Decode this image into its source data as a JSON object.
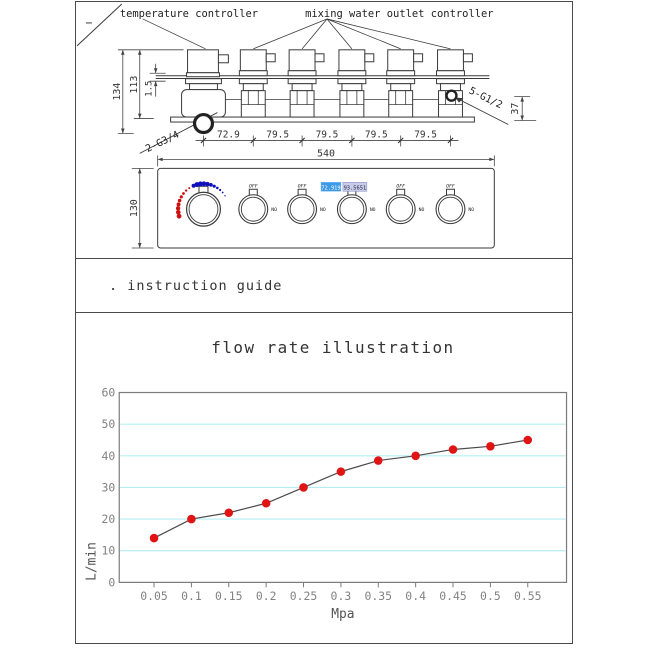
{
  "drawing": {
    "labels": {
      "temperature_controller": "temperature controller",
      "mixing_controller": "mixing water outlet controller",
      "port_bottom": "2-G3/4",
      "port_side": "5-G1/2"
    },
    "dims": {
      "total_height": "134",
      "body_height": "113",
      "pipe_offset": "1.5",
      "side_depth": "37",
      "spacing_labels": [
        "72.9",
        "79.5",
        "79.5",
        "79.5",
        "79.5"
      ],
      "total_width": "540",
      "panel_height": "130"
    },
    "panel": {
      "knob_top_label": "OFF",
      "knob_side_label": "NO",
      "display_value_1": "172.9199",
      "display_value_2": "93.5651",
      "knob_count": 6,
      "temp_arc_hot_color": "#cc1111",
      "temp_arc_cold_color": "#1111bb"
    }
  },
  "instruction": {
    "text": ". instruction guide"
  },
  "chart_data": {
    "type": "line",
    "title": "flow rate illustration",
    "xlabel": "Mpa",
    "ylabel": "L/min",
    "x": [
      0.05,
      0.1,
      0.15,
      0.2,
      0.25,
      0.3,
      0.35,
      0.4,
      0.45,
      0.5,
      0.55
    ],
    "x_tick_labels": [
      "0.05",
      "0.1",
      "0.15",
      "0.2",
      "0.25",
      "0.3",
      "0.35",
      "0.4",
      "0.45",
      "0.5",
      "0.55"
    ],
    "values": [
      14,
      20,
      22,
      25,
      30,
      35,
      38.5,
      40,
      42,
      43,
      45
    ],
    "y_ticks": [
      0,
      10,
      20,
      30,
      40,
      50,
      60
    ],
    "ylim": [
      0,
      60
    ],
    "grid": true,
    "legend_position": "none",
    "colors": {
      "point": "#e01414",
      "line": "#4a4a4a",
      "grid": "#b5edf1",
      "axis": "#7a7a7a",
      "tick_text": "#828282"
    }
  }
}
